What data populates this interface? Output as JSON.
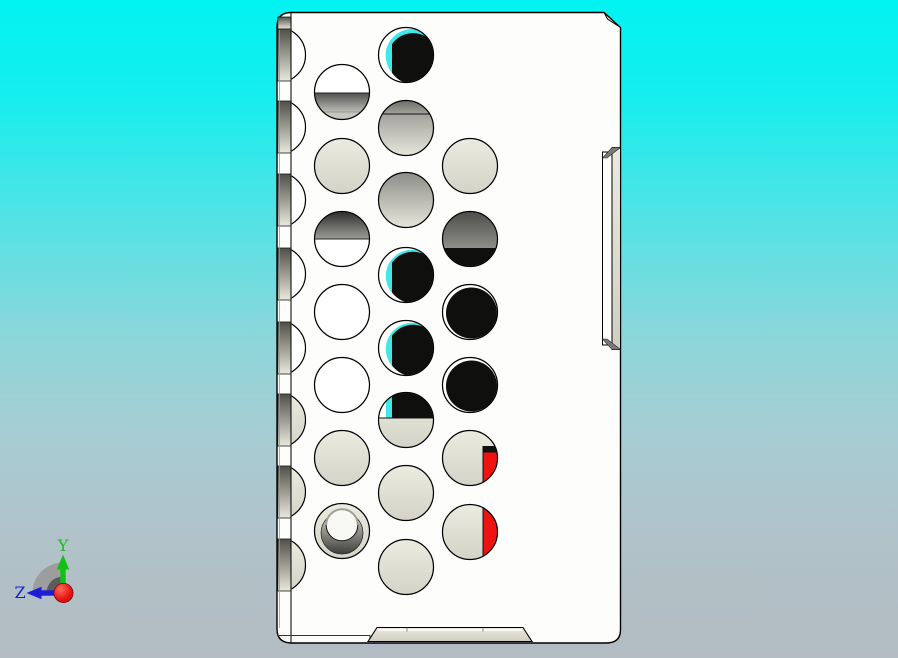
{
  "triad": {
    "axis_y": {
      "label": "Y",
      "color": "#12c212"
    },
    "axis_z": {
      "label": "Z",
      "color": "#1d1dd6"
    },
    "origin_color": "#e01010",
    "quadrant_color": "#989898",
    "quadrant_inner_color": "#5c5c5c"
  },
  "part": {
    "colors": {
      "face_white": "#fdfdfc",
      "outline": "#000000",
      "beige_light": "#ecebe0",
      "beige_dark": "#d4d3c8",
      "hole_black": "#0f0f0d",
      "cyan": "#40e8ea",
      "red": "#ee1311"
    }
  },
  "edge_holes": [
    {
      "cy": 55,
      "fill": "white"
    },
    {
      "cy": 127,
      "fill": "white"
    },
    {
      "cy": 200,
      "fill": "white"
    },
    {
      "cy": 274,
      "fill": "white"
    },
    {
      "cy": 348,
      "fill": "white"
    },
    {
      "cy": 420,
      "fill": "beige"
    },
    {
      "cy": 492,
      "fill": "beige"
    },
    {
      "cy": 565,
      "fill": "beige"
    }
  ],
  "holes": [
    {
      "x": 406,
      "y": 55,
      "r": 27.5,
      "type": "black_cyan_top"
    },
    {
      "x": 342,
      "y": 92,
      "r": 27.5,
      "type": "white_band_bottom"
    },
    {
      "x": 406,
      "y": 128,
      "r": 27.5,
      "type": "gray_top_band"
    },
    {
      "x": 342,
      "y": 166,
      "r": 27.5,
      "type": "beige"
    },
    {
      "x": 470,
      "y": 166,
      "r": 27.5,
      "type": "beige"
    },
    {
      "x": 406,
      "y": 200,
      "r": 27.5,
      "type": "gray_gradient"
    },
    {
      "x": 342,
      "y": 239,
      "r": 27.5,
      "type": "dark_top_half"
    },
    {
      "x": 470,
      "y": 239,
      "r": 27.5,
      "type": "dark_top_black_bottom"
    },
    {
      "x": 406,
      "y": 275,
      "r": 27.5,
      "type": "black_cyan"
    },
    {
      "x": 342,
      "y": 312,
      "r": 27.5,
      "type": "white"
    },
    {
      "x": 470,
      "y": 312,
      "r": 27.5,
      "type": "black"
    },
    {
      "x": 406,
      "y": 348,
      "r": 27.5,
      "type": "black_cyan"
    },
    {
      "x": 342,
      "y": 385,
      "r": 27.5,
      "type": "white"
    },
    {
      "x": 470,
      "y": 385,
      "r": 27.5,
      "type": "black"
    },
    {
      "x": 406,
      "y": 420,
      "r": 27.5,
      "type": "black_top_beige_bottom"
    },
    {
      "x": 342,
      "y": 458,
      "r": 27.5,
      "type": "beige"
    },
    {
      "x": 470,
      "y": 458,
      "r": 27.5,
      "type": "beige_red_wedge"
    },
    {
      "x": 406,
      "y": 493,
      "r": 27.5,
      "type": "beige"
    },
    {
      "x": 342,
      "y": 531,
      "r": 27.5,
      "type": "counterbore"
    },
    {
      "x": 470,
      "y": 532,
      "r": 27.5,
      "type": "beige_red_half"
    },
    {
      "x": 406,
      "y": 567,
      "r": 27.5,
      "type": "beige"
    }
  ]
}
